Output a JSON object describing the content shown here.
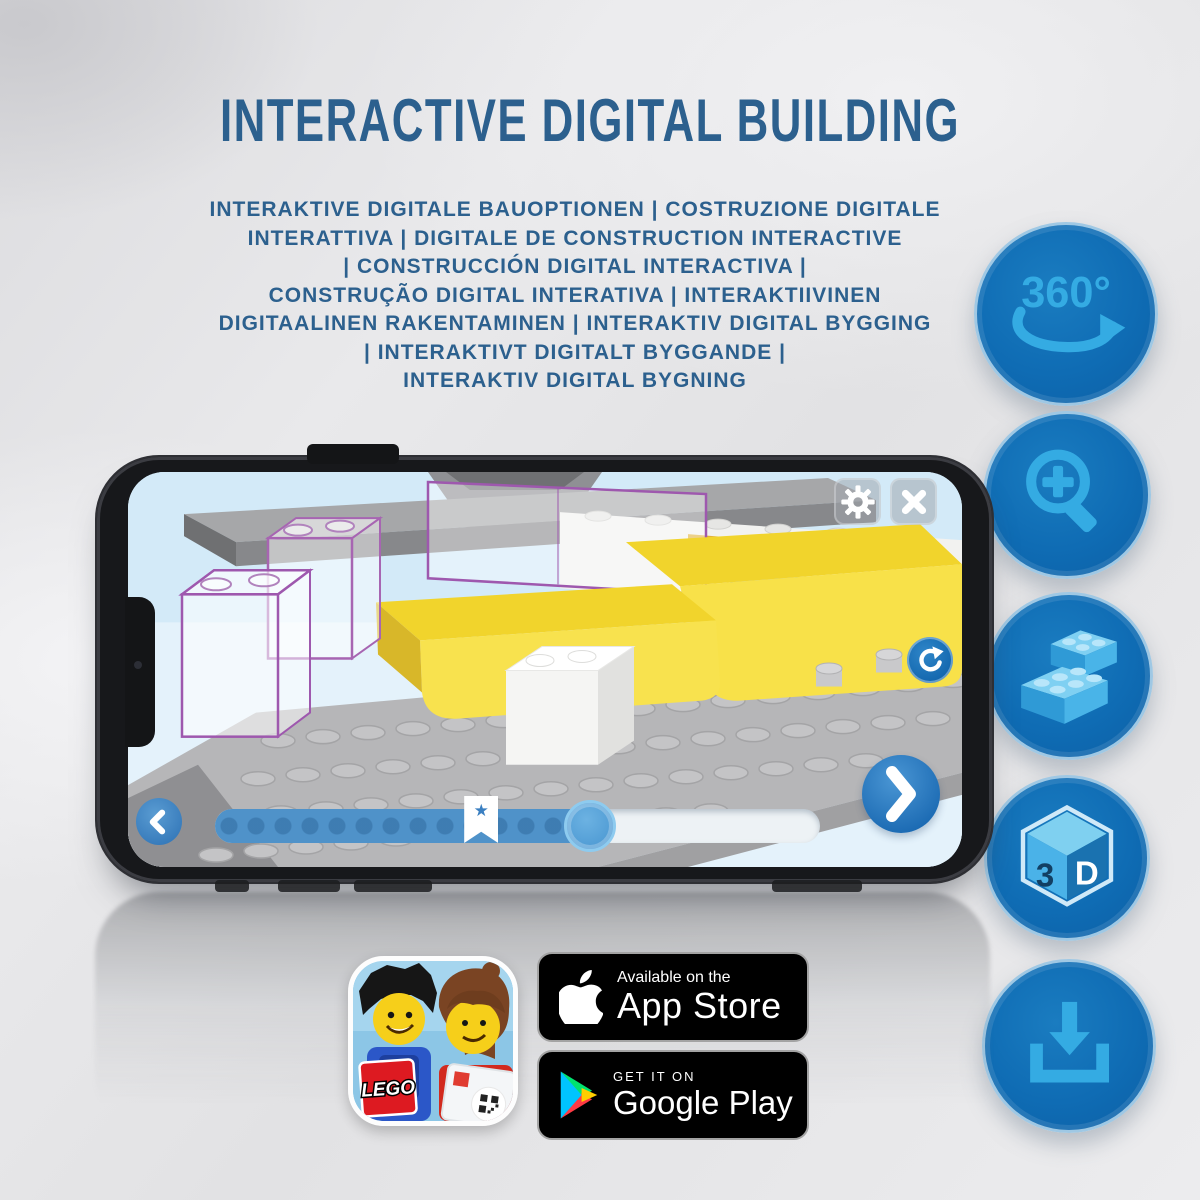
{
  "header": {
    "title": "INTERACTIVE DIGITAL BUILDING",
    "subtitle_lines": [
      "INTERAKTIVE DIGITALE BAUOPTIONEN | COSTRUZIONE DIGITALE",
      "INTERATTIVA | DIGITALE DE CONSTRUCTION INTERACTIVE",
      "| CONSTRUCCIÓN DIGITAL INTERACTIVA |",
      "CONSTRUÇÃO DIGITAL INTERATIVA | INTERAKTIIVINEN",
      "DIGITAALINEN RAKENTAMINEN | INTERAKTIV DIGITAL BYGGING",
      "| INTERAKTIVT DIGITALT BYGGANDE |",
      "INTERAKTIV DIGITAL BYGNING"
    ]
  },
  "feature_buttons": {
    "rotation_label": "360°",
    "cube_left": "3",
    "cube_right": "D",
    "icons": [
      "rotate-360-icon",
      "zoom-in-icon",
      "brick-stack-icon",
      "3d-cube-icon",
      "download-icon"
    ]
  },
  "phone": {
    "slider": {
      "progress_percent": 62,
      "bookmark_percent": 44,
      "bookmark_star": "★"
    },
    "screen_icons": [
      "gear-icon",
      "close-icon",
      "rotate-view-icon",
      "chevron-left-icon",
      "chevron-right-icon"
    ]
  },
  "store_badges": {
    "app_store": {
      "tagline": "Available on the",
      "name": "App Store"
    },
    "google_play": {
      "tagline": "GET IT ON",
      "name": "Google Play"
    }
  },
  "app_icon": {
    "logo_text": "LEGO"
  },
  "colors": {
    "headline_blue": "#2c608e",
    "feature_circle_blue": "#0f6cb4",
    "feature_glyph_blue": "#33a9e2",
    "brick_yellow": "#f1d42c",
    "ghost_outline_purple": "#9e58ae",
    "app_button_blue": "#2a7ac2",
    "slider_fill_blue": "#4f92c9",
    "lego_logo_red": "#dd1a21",
    "background_grey": "#e4e4e6"
  }
}
